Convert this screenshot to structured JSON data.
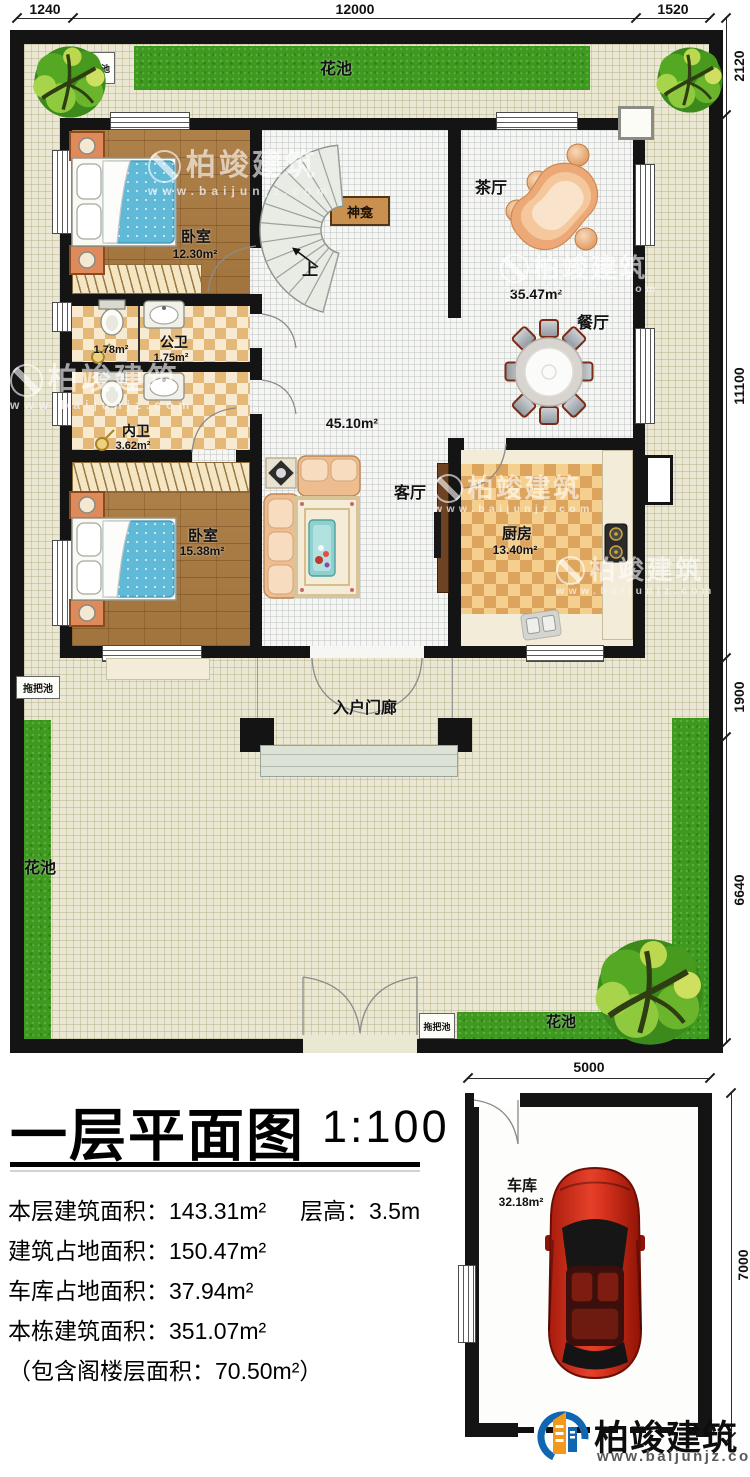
{
  "plan": {
    "dims_top": [
      "1240",
      "12000",
      "1520"
    ],
    "dims_right": [
      "2120",
      "11100",
      "1900",
      "6640"
    ],
    "garage_dims": {
      "width": "5000",
      "height": "7000"
    }
  },
  "garden": {
    "flower_bed": "花池",
    "mop_pool": "拖把池"
  },
  "rooms": {
    "bedroom1": {
      "name": "卧室",
      "area": "12.30m²"
    },
    "bedroom2": {
      "name": "卧室",
      "area": "15.38m²"
    },
    "shower": {
      "area": "1.78m²"
    },
    "public_bath": {
      "name": "公卫",
      "area": "1.75m²"
    },
    "private_bath": {
      "name": "内卫",
      "area": "3.62m²"
    },
    "tea_hall": {
      "name": "茶厅"
    },
    "dining": {
      "name": "餐厅",
      "area": "35.47m²"
    },
    "living": {
      "name": "客厅",
      "area": "45.10m²"
    },
    "kitchen": {
      "name": "厨房",
      "area": "13.40m²"
    },
    "porch": {
      "name": "入户门廊"
    },
    "shrine": {
      "name": "神龛"
    },
    "stairs": {
      "direction": "上"
    },
    "garage": {
      "name": "车库",
      "area": "32.18m²"
    }
  },
  "title_block": {
    "title": "一层平面图",
    "scale": "1:100",
    "stats": [
      "本层建筑面积：143.31m²",
      "层高：3.5m",
      "建筑占地面积：150.47m²",
      "车库占地面积：37.94m²",
      "本栋建筑面积：351.07m²",
      "（包含阁楼层面积：70.50m²）"
    ]
  },
  "branding": {
    "company": "柏竣建筑",
    "website": "www.baijunjz.com"
  }
}
